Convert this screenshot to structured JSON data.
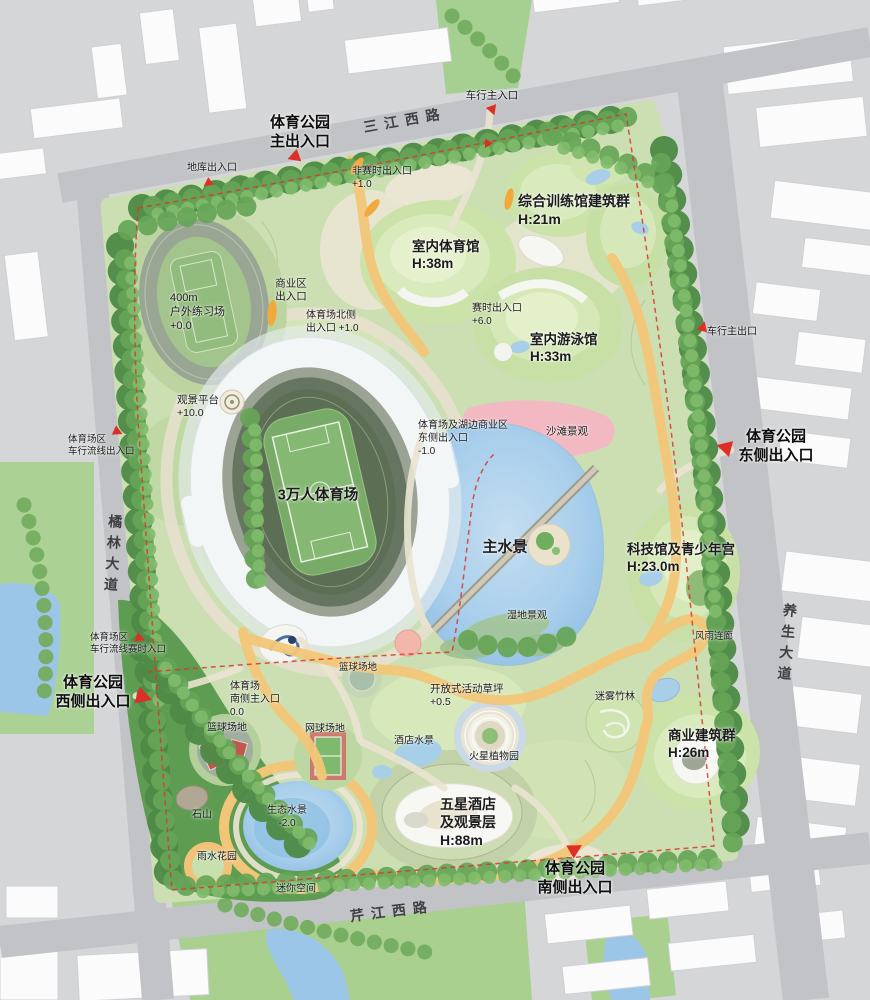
{
  "park_name": "体育公园",
  "colors": {
    "path_accent": "#f2c678",
    "water": "#a9cfec",
    "boundary_red": "#d8372e",
    "beach_pink": "#f3b9c2",
    "park_green": "#ccdfb3"
  },
  "roads": [
    {
      "id": "road-sanjiang-west",
      "text": "三江西路",
      "x": 405,
      "y": 121,
      "size": 14,
      "bold": true,
      "center": true,
      "rot": -10
    },
    {
      "id": "road-julin-avenue",
      "text": "橘林大道",
      "x": 112,
      "y": 556,
      "size": 14,
      "bold": true,
      "center": true,
      "rot": 4,
      "vertical": true
    },
    {
      "id": "road-yangsheng-avenue",
      "text": "养生大道",
      "x": 786,
      "y": 645,
      "size": 14,
      "bold": true,
      "center": true,
      "rot": 5,
      "vertical": true
    },
    {
      "id": "road-qinjiang-west",
      "text": "芹江西路",
      "x": 392,
      "y": 912,
      "size": 14,
      "bold": true,
      "center": true,
      "rot": -7
    }
  ],
  "entrances": [
    {
      "id": "park-main-entrance",
      "text": "体育公园\n主出入口",
      "x": 300,
      "y": 132,
      "size": 15,
      "bold": true,
      "center": true
    },
    {
      "id": "park-east-entrance",
      "text": "体育公园\n东侧出入口",
      "x": 776,
      "y": 446,
      "size": 15,
      "bold": true,
      "center": true
    },
    {
      "id": "park-west-entrance",
      "text": "体育公园\n西侧出入口",
      "x": 93,
      "y": 692,
      "size": 15,
      "bold": true,
      "center": true
    },
    {
      "id": "park-south-entrance",
      "text": "体育公园\n南侧出入口",
      "x": 575,
      "y": 878,
      "size": 15,
      "bold": true,
      "center": true
    }
  ],
  "features": [
    {
      "id": "garage-entrance",
      "text": "地库出入口",
      "x": 212,
      "y": 169,
      "size": 10,
      "center": true
    },
    {
      "id": "non-event-entrance",
      "text": "非赛时出入口\n+1.0",
      "x": 352,
      "y": 166,
      "size": 10
    },
    {
      "id": "vehicle-main-entrance",
      "text": "车行主入口",
      "x": 492,
      "y": 96,
      "size": 10.5,
      "center": true
    },
    {
      "id": "training-halls",
      "text": "综合训练馆建筑群\nH:21m",
      "x": 518,
      "y": 193,
      "size": 14,
      "bold": true
    },
    {
      "id": "indoor-gymnasium",
      "text": "室内体育馆\nH:38m",
      "x": 412,
      "y": 238,
      "size": 13.5,
      "bold": true
    },
    {
      "id": "commercial-zone-entrance",
      "text": "商业区\n出入口",
      "x": 291,
      "y": 291,
      "size": 10.5,
      "center": true
    },
    {
      "id": "stadium-north-entrance",
      "text": "体育场北侧\n出入口 +1.0",
      "x": 306,
      "y": 310,
      "size": 10
    },
    {
      "id": "practice-field-400m",
      "text": "400m\n户外练习场\n+0.0",
      "x": 170,
      "y": 291,
      "size": 11
    },
    {
      "id": "viewing-platform",
      "text": "观景平台\n+10.0",
      "x": 177,
      "y": 394,
      "size": 10.5
    },
    {
      "id": "event-time-entrance",
      "text": "赛时出入口\n+6.0",
      "x": 472,
      "y": 303,
      "size": 10
    },
    {
      "id": "indoor-swimming-hall",
      "text": "室内游泳馆\nH:33m",
      "x": 530,
      "y": 331,
      "size": 13.5,
      "bold": true
    },
    {
      "id": "beach-landscape",
      "text": "沙滩景观",
      "x": 567,
      "y": 432,
      "size": 10.5,
      "center": true
    },
    {
      "id": "lakeside-commercial-east-entrance",
      "text": "体育场及湖边商业区\n东侧出入口\n-1.0",
      "x": 418,
      "y": 420,
      "size": 10
    },
    {
      "id": "stadium-30000",
      "text": "3万人体育场",
      "x": 318,
      "y": 496,
      "size": 14.5,
      "bold": true,
      "center": true
    },
    {
      "id": "main-water-feature",
      "text": "主水景",
      "x": 505,
      "y": 547,
      "size": 15,
      "bold": true,
      "center": true
    },
    {
      "id": "wetland-landscape",
      "text": "湿地景观",
      "x": 527,
      "y": 617,
      "size": 10,
      "center": true
    },
    {
      "id": "science-youth-palace",
      "text": "科技馆及青少年宫\nH:23.0m",
      "x": 627,
      "y": 541,
      "size": 13.5,
      "bold": true
    },
    {
      "id": "rain-corridor",
      "text": "风雨连廊",
      "x": 714,
      "y": 637,
      "size": 9.5,
      "center": true
    },
    {
      "id": "misty-bamboo-grove",
      "text": "迷雾竹林",
      "x": 615,
      "y": 698,
      "size": 10,
      "center": true
    },
    {
      "id": "commercial-building-group",
      "text": "商业建筑群\nH:26m",
      "x": 668,
      "y": 727,
      "size": 13.5,
      "bold": true
    },
    {
      "id": "stadium-south-main-entrance",
      "text": "体育场\n南侧主入口\n0.0",
      "x": 230,
      "y": 681,
      "size": 10
    },
    {
      "id": "ball-court-upper",
      "text": "篮球场地",
      "x": 358,
      "y": 668,
      "size": 9.5,
      "center": true
    },
    {
      "id": "basketball-court",
      "text": "篮球场地",
      "x": 227,
      "y": 729,
      "size": 10,
      "center": true
    },
    {
      "id": "tennis-court",
      "text": "网球场地",
      "x": 325,
      "y": 730,
      "size": 10,
      "center": true
    },
    {
      "id": "open-activity-lawn",
      "text": "开放式活动草坪\n+0.5",
      "x": 430,
      "y": 683,
      "size": 10.5
    },
    {
      "id": "hotel-water-feature",
      "text": "酒店水景",
      "x": 414,
      "y": 742,
      "size": 10,
      "center": true
    },
    {
      "id": "mars-botanical-garden",
      "text": "火星植物园",
      "x": 494,
      "y": 758,
      "size": 10,
      "center": true
    },
    {
      "id": "five-star-hotel",
      "text": "五星酒店\n及观景层\nH:88m",
      "x": 440,
      "y": 796,
      "size": 14,
      "bold": true
    },
    {
      "id": "rock-hill",
      "text": "石山",
      "x": 202,
      "y": 816,
      "size": 10,
      "center": true
    },
    {
      "id": "eco-water-feature",
      "text": "生态水景\n-2.0",
      "x": 287,
      "y": 818,
      "size": 10,
      "center": true
    },
    {
      "id": "rain-garden",
      "text": "雨水花园",
      "x": 217,
      "y": 858,
      "size": 10,
      "center": true
    },
    {
      "id": "mini-space",
      "text": "迷你空间",
      "x": 296,
      "y": 890,
      "size": 10,
      "center": true
    },
    {
      "id": "west-vehicle-entrance",
      "text": "体育场区\n车行流线出入口",
      "x": 68,
      "y": 434,
      "size": 9.5
    },
    {
      "id": "west-vehicle-event-entrance",
      "text": "体育场区\n车行流线赛时入口",
      "x": 90,
      "y": 632,
      "size": 9.5
    },
    {
      "id": "vehicle-main-exit",
      "text": "车行主出口",
      "x": 732,
      "y": 333,
      "size": 10,
      "center": true
    }
  ]
}
